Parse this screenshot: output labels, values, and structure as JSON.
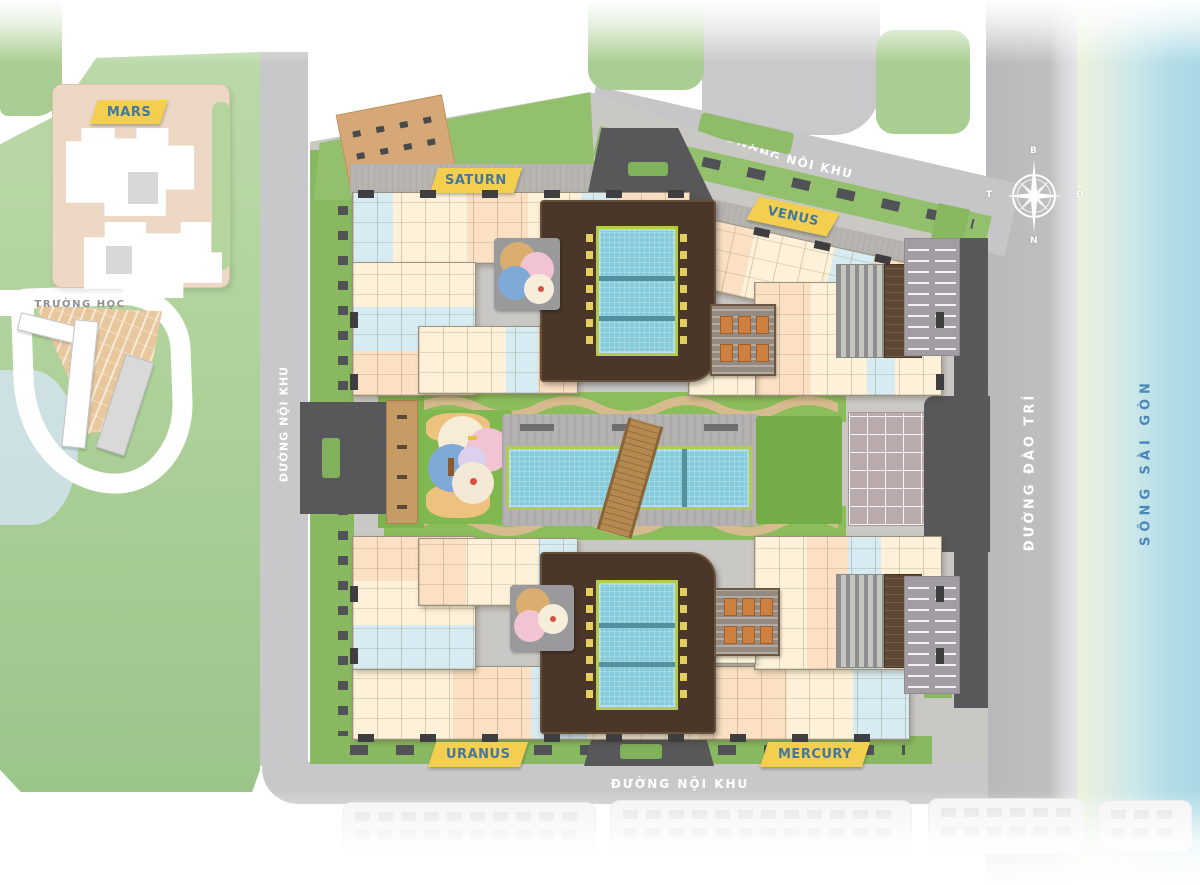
{
  "plan": {
    "towers": [
      {
        "id": "mars",
        "label": "MARS"
      },
      {
        "id": "saturn",
        "label": "SATURN"
      },
      {
        "id": "venus",
        "label": "VENUS"
      },
      {
        "id": "uranus",
        "label": "URANUS"
      },
      {
        "id": "mercury",
        "label": "MERCURY"
      }
    ],
    "school_label": "TRƯỜNG HỌC",
    "roads": {
      "top": "ĐƯỜNG NỘI KHU",
      "left": "ĐƯỜNG NỘI KHU",
      "bottom": "ĐƯỜNG NỘI KHU",
      "right": "ĐƯỜNG ĐÀO TRÍ"
    },
    "river_label": "SÔNG SÀI GÒN",
    "compass": {
      "north": "B",
      "south": "N",
      "east": "Đ",
      "west": "T"
    }
  },
  "colors": {
    "tag_yellow": "#f4cf4f",
    "tag_text_blue": "#44779f",
    "park_green": "#b7d6a2",
    "site_lawn": "#8cbd5b",
    "deck_brown": "#4a3729",
    "pool_blue": "#85cbdb",
    "road_gray": "#c6c6c8",
    "drive_dark": "#58585a",
    "river_blue": "#b2dde6",
    "river_bank": "#eef3da"
  }
}
